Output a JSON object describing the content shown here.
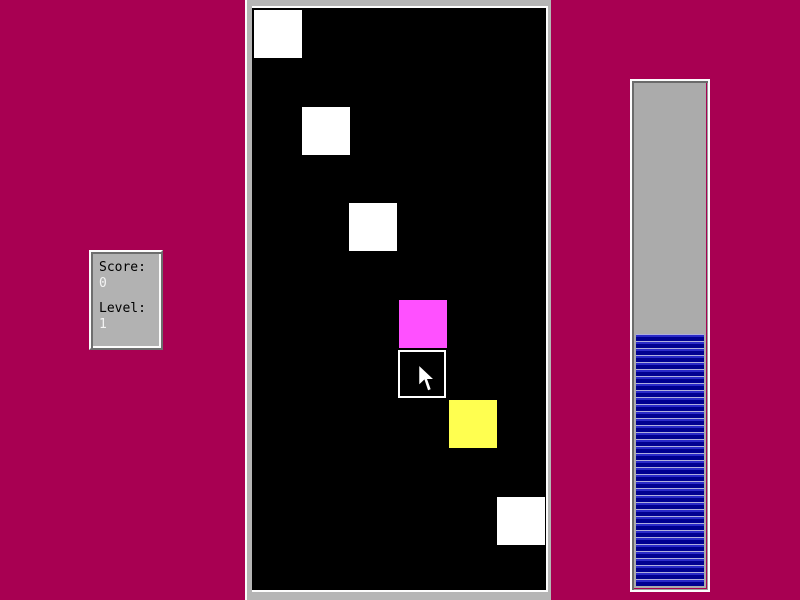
{
  "app": {
    "name": "block-puzzle-game",
    "background_color": "#a80052"
  },
  "score_panel": {
    "score_label": "Score:",
    "score_value": "0",
    "level_label": "Level:",
    "level_value": "1",
    "panel_color": "#b2b2b2",
    "label_color": "#000000",
    "value_color": "#f4f4f4"
  },
  "playfield": {
    "background_color": "#000000",
    "frame_color": "#b5b5b5",
    "block_size": 48,
    "blocks": [
      {
        "x": 2,
        "y": 2,
        "color": "#ffffff",
        "type": "solid"
      },
      {
        "x": 50,
        "y": 99,
        "color": "#ffffff",
        "type": "solid"
      },
      {
        "x": 97,
        "y": 195,
        "color": "#ffffff",
        "type": "solid"
      },
      {
        "x": 147,
        "y": 292,
        "color": "#ff50ff",
        "type": "solid"
      },
      {
        "x": 146,
        "y": 342,
        "color": "#000000",
        "type": "outline"
      },
      {
        "x": 197,
        "y": 392,
        "color": "#ffff50",
        "type": "solid"
      },
      {
        "x": 245,
        "y": 489,
        "color": "#ffffff",
        "type": "solid"
      }
    ],
    "cursor": {
      "x": 166,
      "y": 356,
      "icon": "arrow-pointer-icon"
    }
  },
  "progress_bar": {
    "fill_percent": 50,
    "trough_color": "#ababab",
    "fill_color_dark": "#000090",
    "fill_color_light": "#2a2ac8"
  }
}
